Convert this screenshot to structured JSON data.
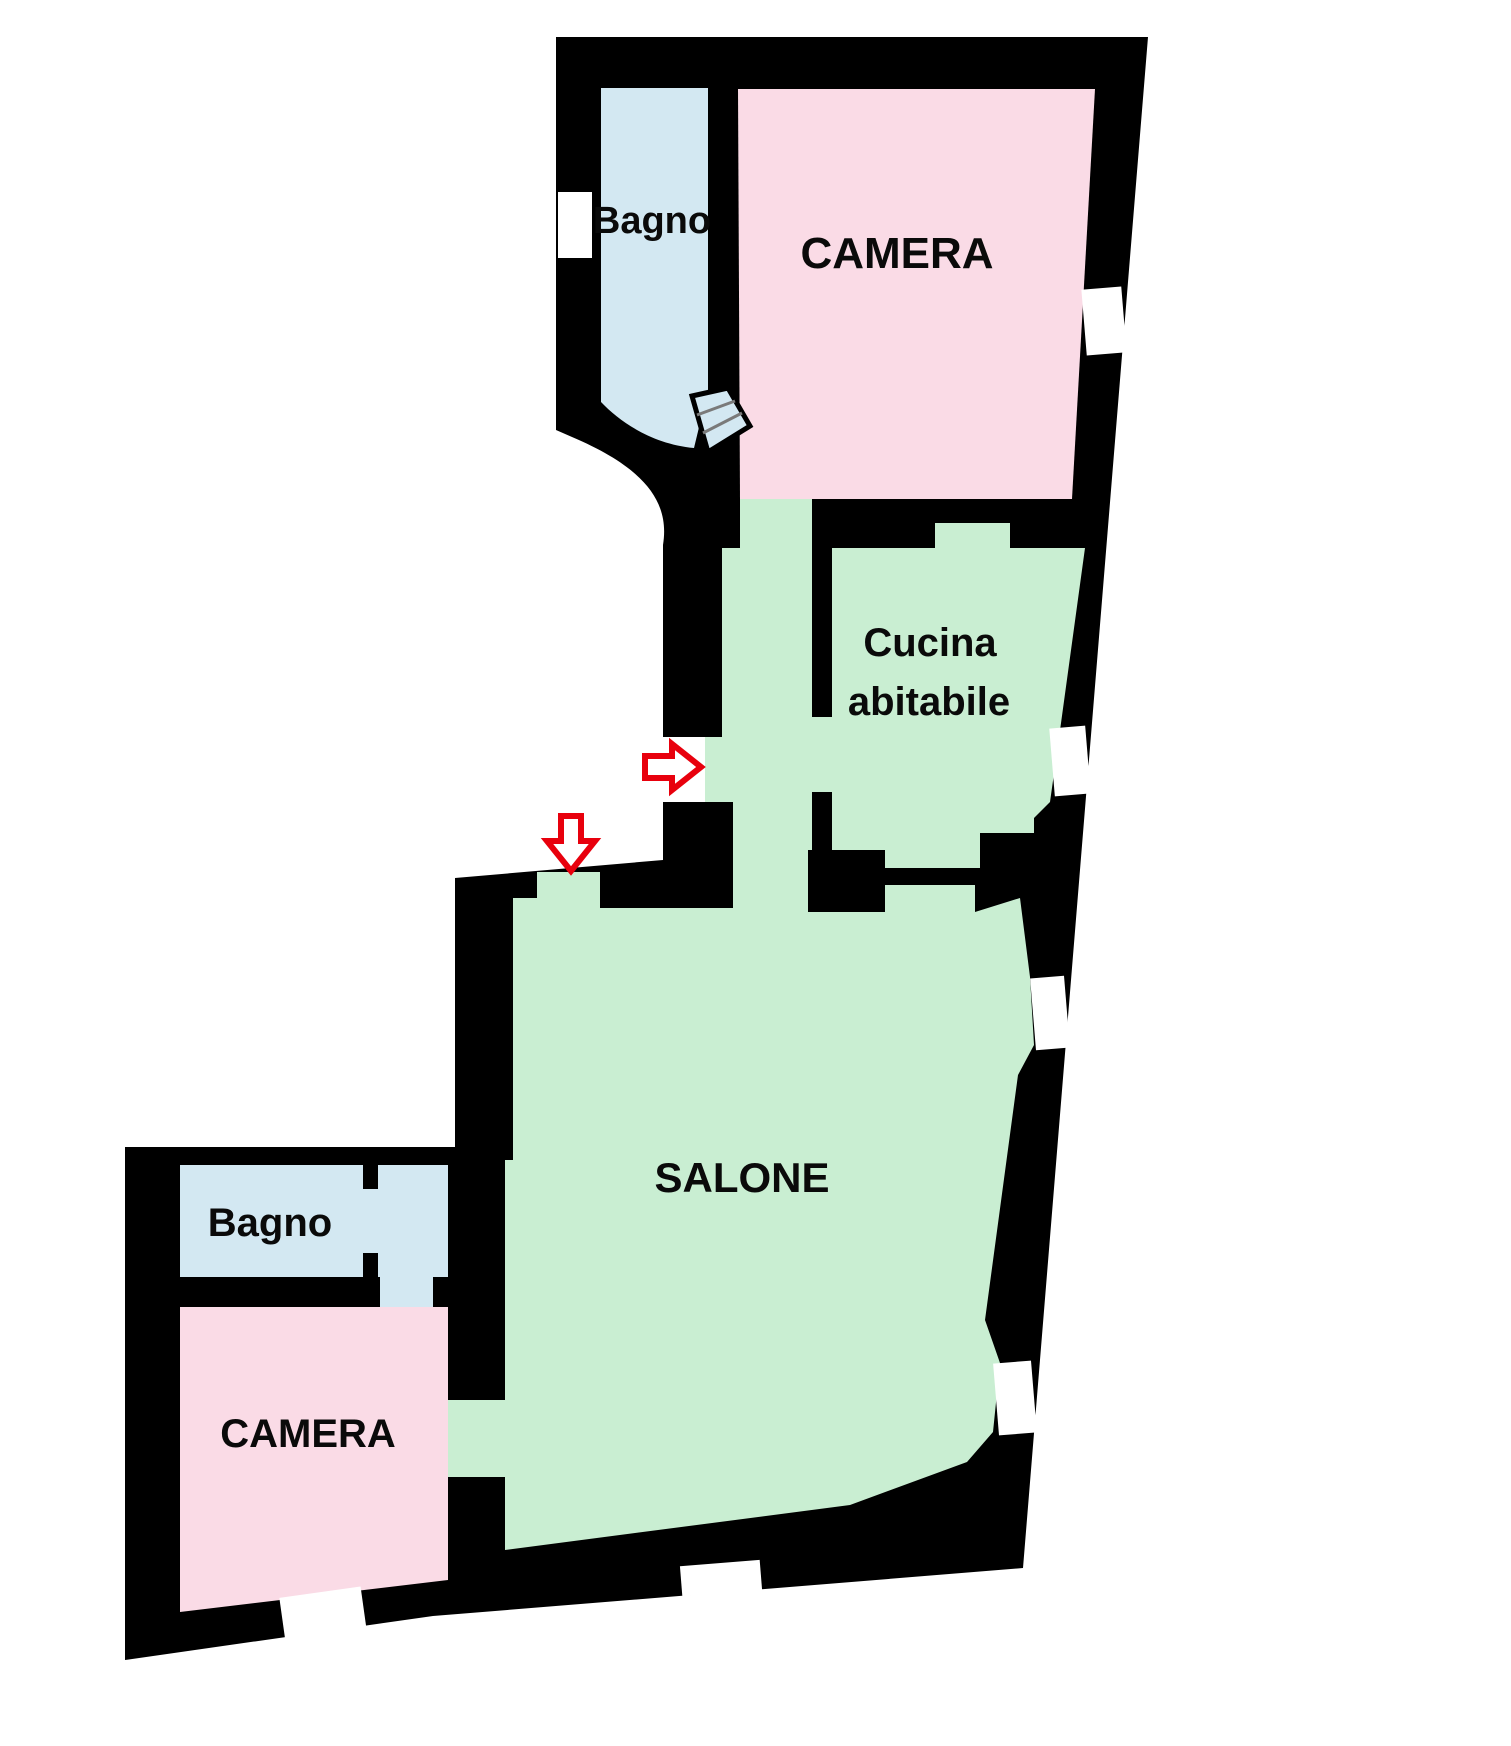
{
  "title": "Apartment floor plan",
  "colors": {
    "wall": "#000000",
    "background": "#ffffff",
    "room_bath": "#d3e8f2",
    "room_bedroom": "#fadbe6",
    "room_living": "#c9eed2",
    "opening": "#ffffff",
    "arrow": "#e8000d",
    "hatch": "#7a7a7a",
    "label": "#0a0a0a"
  },
  "rooms": [
    {
      "id": "bagno-top",
      "label": "Bagno"
    },
    {
      "id": "camera-top",
      "label": "CAMERA"
    },
    {
      "id": "cucina",
      "label": "Cucina abitabile",
      "line1": "Cucina",
      "line2": "abitabile"
    },
    {
      "id": "salone",
      "label": "SALONE"
    },
    {
      "id": "bagno-bottom",
      "label": "Bagno"
    },
    {
      "id": "camera-bottom",
      "label": "CAMERA"
    }
  ],
  "arrows": [
    {
      "id": "entrance-arrow-right",
      "direction": "right"
    },
    {
      "id": "entrance-arrow-down",
      "direction": "down"
    }
  ]
}
